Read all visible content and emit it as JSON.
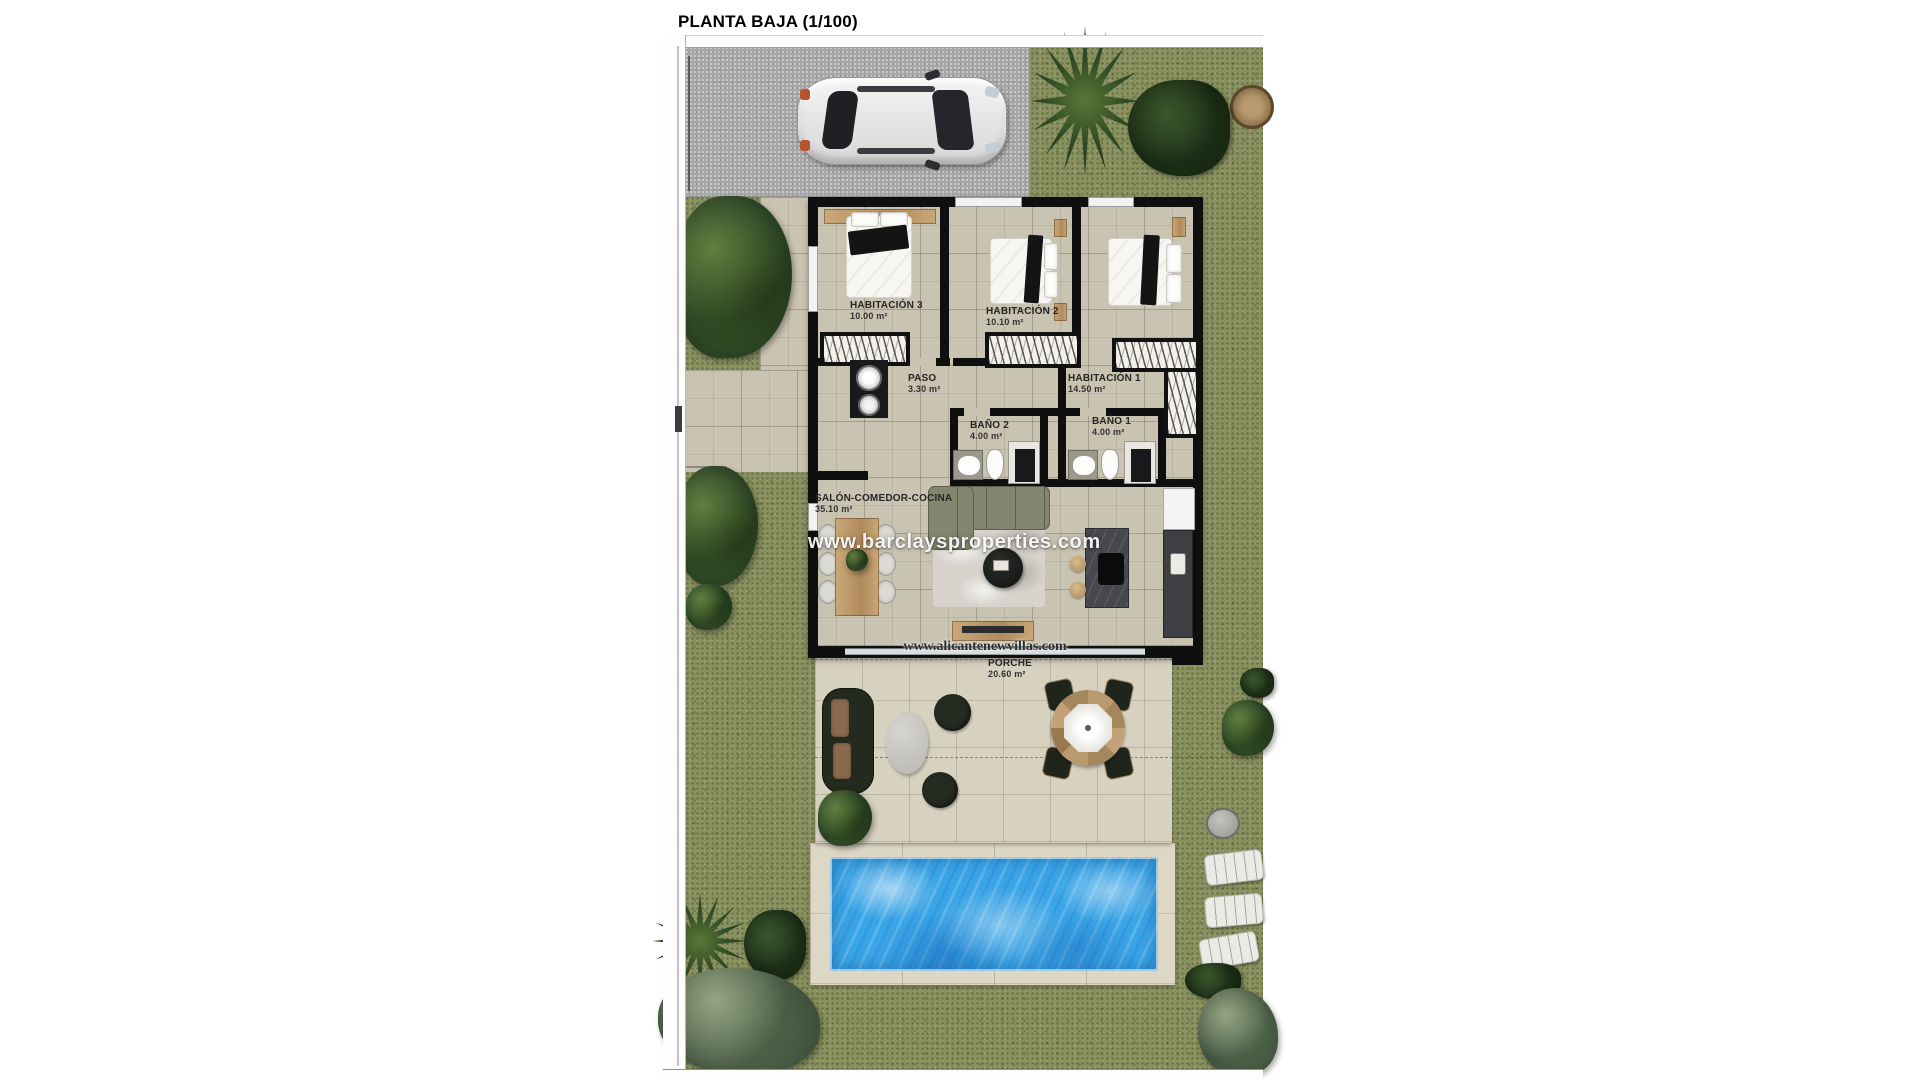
{
  "title": "PLANTA BAJA (1/100)",
  "watermarks": {
    "primary": "www.barclaysproperties.com",
    "secondary": "www.alicantenewvillas.com"
  },
  "rooms": [
    {
      "id": "habitacion-3",
      "name": "HABITACIÓN 3",
      "area": "10.00 m²"
    },
    {
      "id": "habitacion-2",
      "name": "HABITACIÓN 2",
      "area": "10.10 m²"
    },
    {
      "id": "habitacion-1",
      "name": "HABITACIÓN 1",
      "area": "14.50 m²"
    },
    {
      "id": "paso",
      "name": "PASO",
      "area": "3.30 m²"
    },
    {
      "id": "bano-2",
      "name": "BAÑO 2",
      "area": "4.00 m²"
    },
    {
      "id": "bano-1",
      "name": "BAÑO 1",
      "area": "4.00 m²"
    },
    {
      "id": "salon",
      "name": "SALÓN-COMEDOR-COCINA",
      "area": "35.10 m²"
    },
    {
      "id": "porche",
      "name": "PORCHE",
      "area": "20.60 m²"
    }
  ],
  "colors": {
    "grass": "#8a9160",
    "interior_tile": "#c9c3b2",
    "porch_tile": "#d7d1c0",
    "pool_water": "#3aa5e6",
    "pool_deck": "#ddd7c5",
    "wall": "#0f0f0f",
    "driveway": "#a7a7a7",
    "background": "#ffffff"
  }
}
